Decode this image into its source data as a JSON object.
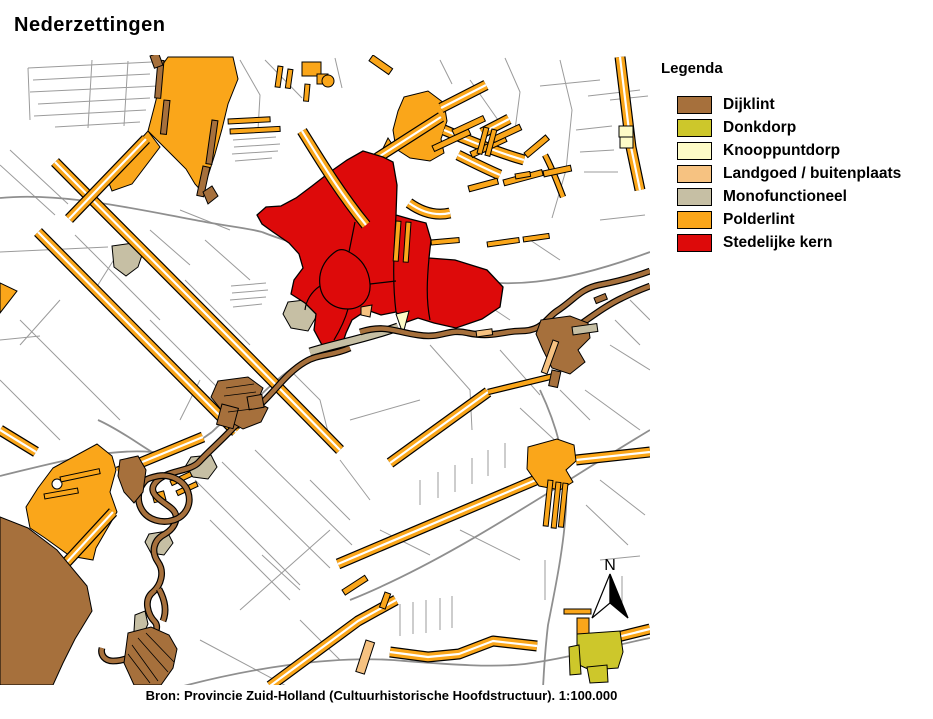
{
  "title": "Nederzettingen",
  "legend": {
    "title": "Legenda",
    "items": [
      {
        "label": "Dijklint",
        "key": "dijklint",
        "color": "#A6703C"
      },
      {
        "label": "Donkdorp",
        "key": "donkdorp",
        "color": "#CDC72B"
      },
      {
        "label": "Knooppuntdorp",
        "key": "knooppuntdorp",
        "color": "#FDFBC7"
      },
      {
        "label": "Landgoed / buitenplaats",
        "key": "landgoed",
        "color": "#F6C281"
      },
      {
        "label": "Monofunctioneel",
        "key": "monofunctioneel",
        "color": "#C6BFA4"
      },
      {
        "label": "Polderlint",
        "key": "polderlint",
        "color": "#FAA61A"
      },
      {
        "label": "Stedelijke kern",
        "key": "stedelijke_kern",
        "color": "#DD0A0A"
      }
    ]
  },
  "map": {
    "north_label": "N"
  },
  "colors": {
    "parcel": "#9B9B9B",
    "road": "#8F8F8F",
    "outline": "#000000",
    "background": "#FFFFFF"
  },
  "caption": "Bron: Provincie Zuid-Holland (Cultuurhistorische Hoofdstructuur). 1:100.000"
}
